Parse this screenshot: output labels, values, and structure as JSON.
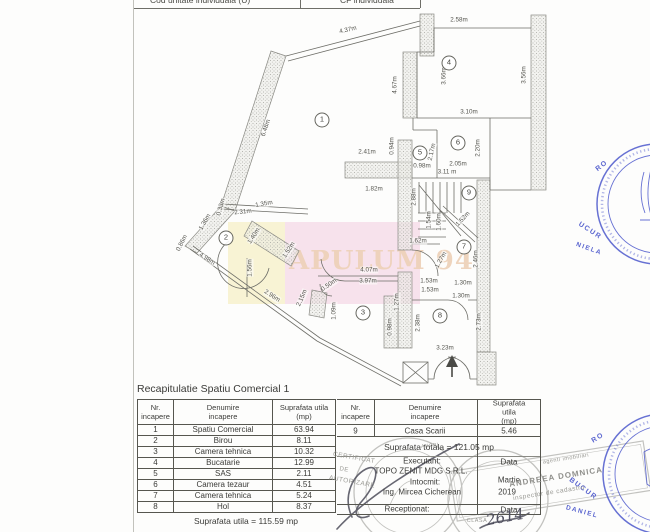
{
  "header_strip": {
    "left": "Cod unitate individuala (U)",
    "right": "CF individuala"
  },
  "watermark": {
    "text": "APULUM 94",
    "yellow": "#f8f3d4",
    "pink": "#f7e2ec",
    "text_color": "#eed2ba"
  },
  "floor_plan": {
    "rooms": [
      {
        "n": "1",
        "x": 322,
        "y": 120
      },
      {
        "n": "2",
        "x": 226,
        "y": 238
      },
      {
        "n": "3",
        "x": 363,
        "y": 313
      },
      {
        "n": "4",
        "x": 449,
        "y": 63
      },
      {
        "n": "5",
        "x": 420,
        "y": 153
      },
      {
        "n": "6",
        "x": 458,
        "y": 143
      },
      {
        "n": "7",
        "x": 464,
        "y": 247
      },
      {
        "n": "8",
        "x": 440,
        "y": 316
      },
      {
        "n": "9",
        "x": 469,
        "y": 193
      }
    ],
    "dims": [
      {
        "t": "4.37m",
        "x": 348,
        "y": 30,
        "r": -13
      },
      {
        "t": "2.58m",
        "x": 459,
        "y": 20,
        "r": 0
      },
      {
        "t": "6.48m",
        "x": 266,
        "y": 128,
        "r": -71
      },
      {
        "t": "4.67m",
        "x": 395,
        "y": 85,
        "r": -90
      },
      {
        "t": "3.66m",
        "x": 444,
        "y": 76,
        "r": -90
      },
      {
        "t": "3.56m",
        "x": 524,
        "y": 75,
        "r": -90
      },
      {
        "t": "3.10m",
        "x": 469,
        "y": 112,
        "r": 0
      },
      {
        "t": "2.41m",
        "x": 367,
        "y": 152,
        "r": 0
      },
      {
        "t": "0.94m",
        "x": 392,
        "y": 146,
        "r": -90
      },
      {
        "t": "2.17m",
        "x": 432,
        "y": 152,
        "r": -78
      },
      {
        "t": "0.98m",
        "x": 422,
        "y": 166,
        "r": 0
      },
      {
        "t": "2.05m",
        "x": 458,
        "y": 164,
        "r": 0
      },
      {
        "t": "2.20m",
        "x": 478,
        "y": 148,
        "r": -90
      },
      {
        "t": "1.82m",
        "x": 374,
        "y": 189,
        "r": 0
      },
      {
        "t": "3.11 m",
        "x": 447,
        "y": 172,
        "r": 0
      },
      {
        "t": "2.88m",
        "x": 414,
        "y": 197,
        "r": -90
      },
      {
        "t": "1.54m",
        "x": 429,
        "y": 220,
        "r": -90
      },
      {
        "t": "1.60m",
        "x": 439,
        "y": 222,
        "r": -90
      },
      {
        "t": "1.52m",
        "x": 463,
        "y": 219,
        "r": -47
      },
      {
        "t": "1.62m",
        "x": 418,
        "y": 241,
        "r": 0
      },
      {
        "t": "2.46m",
        "x": 476,
        "y": 259,
        "r": -90
      },
      {
        "t": "1.27m",
        "x": 441,
        "y": 260,
        "r": -60
      },
      {
        "t": "1.53m",
        "x": 429,
        "y": 281,
        "r": 0
      },
      {
        "t": "1.53m",
        "x": 430,
        "y": 290,
        "r": 0
      },
      {
        "t": "1.30m",
        "x": 463,
        "y": 283,
        "r": 0
      },
      {
        "t": "1.30m",
        "x": 461,
        "y": 296,
        "r": 0
      },
      {
        "t": "2.73m",
        "x": 479,
        "y": 322,
        "r": -90
      },
      {
        "t": "3.23m",
        "x": 445,
        "y": 348,
        "r": 0
      },
      {
        "t": "4.07m",
        "x": 369,
        "y": 270,
        "r": 0
      },
      {
        "t": "3.97m",
        "x": 368,
        "y": 281,
        "r": 0
      },
      {
        "t": "1.27m",
        "x": 397,
        "y": 302,
        "r": -90
      },
      {
        "t": "0.98m",
        "x": 390,
        "y": 327,
        "r": -90
      },
      {
        "t": "2.38m",
        "x": 418,
        "y": 323,
        "r": -90
      },
      {
        "t": "1.09m",
        "x": 334,
        "y": 311,
        "r": -90
      },
      {
        "t": "2.15m",
        "x": 302,
        "y": 298,
        "r": -66
      },
      {
        "t": "0.50m",
        "x": 329,
        "y": 285,
        "r": -35
      },
      {
        "t": "4.98m",
        "x": 207,
        "y": 259,
        "r": 33
      },
      {
        "t": "2.96m",
        "x": 272,
        "y": 296,
        "r": 33
      },
      {
        "t": "1.56m",
        "x": 250,
        "y": 268,
        "r": -90
      },
      {
        "t": "1.40m",
        "x": 254,
        "y": 236,
        "r": -57
      },
      {
        "t": "1.52m",
        "x": 289,
        "y": 250,
        "r": -57
      },
      {
        "t": "2.31m",
        "x": 243,
        "y": 212,
        "r": -6
      },
      {
        "t": "1.35m",
        "x": 264,
        "y": 204,
        "r": -10
      },
      {
        "t": "0.33m",
        "x": 221,
        "y": 207,
        "r": -75
      },
      {
        "t": "1.36m",
        "x": 205,
        "y": 222,
        "r": -60
      },
      {
        "t": "0.86m",
        "x": 182,
        "y": 243,
        "r": -63
      }
    ]
  },
  "table": {
    "title": "Recapitulatie Spatiu Comercial 1",
    "col_headers": [
      {
        "l1": "Nr.",
        "l2": "incapere"
      },
      {
        "l1": "Denumire",
        "l2": "incapere"
      },
      {
        "l1": "Suprafata utila",
        "l2": "(mp)"
      }
    ],
    "left_rows": [
      [
        "1",
        "Spatiu Comercial",
        "63.94"
      ],
      [
        "2",
        "Birou",
        "8.11"
      ],
      [
        "3",
        "Camera tehnica",
        "10.32"
      ],
      [
        "4",
        "Bucatarie",
        "12.99"
      ],
      [
        "5",
        "SAS",
        "2.11"
      ],
      [
        "6",
        "Camera tezaur",
        "4.51"
      ],
      [
        "7",
        "Camera tehnica",
        "5.24"
      ],
      [
        "8",
        "Hol",
        "8.37"
      ]
    ],
    "right_row": [
      "9",
      "Casa Scarii",
      "5.46"
    ],
    "total_line": "Suprafata totala = 121.05 mp",
    "utila_line": "Suprafata utila = 115.59 mp",
    "executant_label": "Executant:",
    "executant": "TOPO ZENIT MDG S.R.L.",
    "intocmit_label": "Intocmit:",
    "intocmit": "Ing. Mircea Cicherean",
    "receptionat_label": "Receptionat:",
    "data_label": "Data",
    "month": "Martie",
    "year": "2019",
    "data_label2": "Data"
  },
  "stamps": {
    "fragments": [
      {
        "t": "RO",
        "x": 602,
        "y": 166,
        "r": -38,
        "s": 7,
        "c": "blue"
      },
      {
        "t": "UCUR",
        "x": 590,
        "y": 231,
        "r": 33,
        "s": 7,
        "c": "blue"
      },
      {
        "t": "NIELA",
        "x": 589,
        "y": 249,
        "r": 20,
        "s": 6.5,
        "c": "blue"
      },
      {
        "t": "RO",
        "x": 598,
        "y": 438,
        "r": -32,
        "s": 7,
        "c": "blue"
      },
      {
        "t": "BUCUR",
        "x": 583,
        "y": 489,
        "r": 36,
        "s": 7,
        "c": "blue"
      },
      {
        "t": "DANIEL",
        "x": 582,
        "y": 512,
        "r": 15,
        "s": 6.5,
        "c": "blue"
      },
      {
        "t": "CERTIFICAT",
        "x": 354,
        "y": 458,
        "r": 10,
        "s": 6.5,
        "c": "gray"
      },
      {
        "t": "DE",
        "x": 344,
        "y": 470,
        "r": 10,
        "s": 6,
        "c": "gray"
      },
      {
        "t": "AUTORIZARE",
        "x": 352,
        "y": 482,
        "r": 10,
        "s": 6.5,
        "c": "gray"
      },
      {
        "t": "agenti imobiliari",
        "x": 566,
        "y": 459,
        "r": -9,
        "s": 5.5,
        "c": "gray"
      },
      {
        "t": "ANDREEA DOMNICA",
        "x": 556,
        "y": 477,
        "r": -9,
        "s": 8,
        "c": "grayb"
      },
      {
        "t": "inspector de cadastru",
        "x": 549,
        "y": 493,
        "r": -9,
        "s": 6.5,
        "c": "gray"
      },
      {
        "t": "CLASA",
        "x": 477,
        "y": 521,
        "r": 0,
        "s": 5.5,
        "c": "gray"
      },
      {
        "t": "ANCPI",
        "x": 430,
        "y": 446,
        "r": -6,
        "s": 5,
        "c": "gray"
      },
      {
        "t": "2614",
        "x": 505,
        "y": 517,
        "r": -10,
        "s": 15,
        "c": "hand"
      }
    ]
  }
}
